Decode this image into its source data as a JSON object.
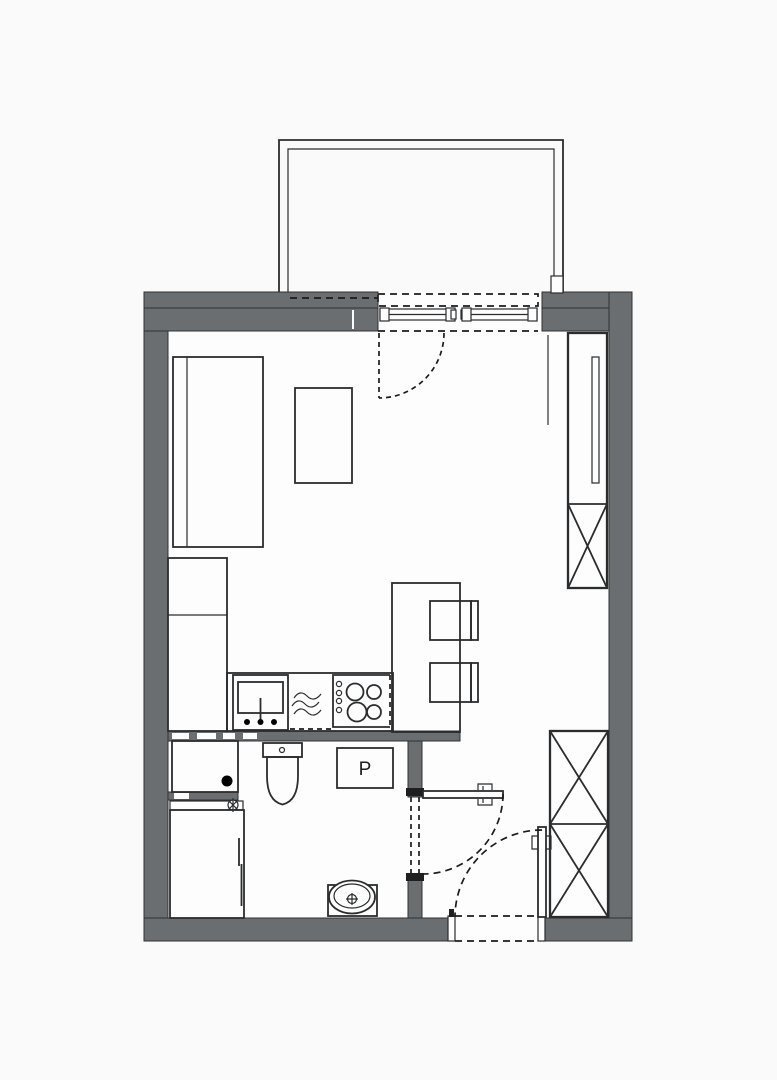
{
  "document": {
    "kind": "studio-apartment-floor-plan",
    "visible_text_labels": {
      "washing_machine": "P"
    }
  },
  "labels": {
    "washing_machine": "P"
  },
  "colors": {
    "wall_fill": "#6b6e70",
    "wall_edge": "#2f3133",
    "line": "#2a2c2e",
    "dash_line": "#1c1c1c",
    "background": "#fafafa",
    "floor": "#fdfdfd",
    "drain_fill": "#000000",
    "label_text": "#1f1f1f"
  },
  "fixtures": {
    "balcony": "balcony with parapet (double outline)",
    "balcony_window": "balcony window, two sliding panels",
    "balcony_door_swing": "dashed door swing arc into room",
    "bed": "single bed with headboard",
    "coffee_table": "coffee table",
    "storage_cabinet": "tall storage cabinet column",
    "kitchen_counter": "kitchen counter run",
    "kitchen_sink": "kitchen sink with faucet",
    "dishwasher": "dishwasher (wave symbol, dashed front)",
    "cooktop": "4-burner cooktop with knobs",
    "breakfast_bar": "kitchen peninsula / breakfast bar",
    "bar_chairs": "two bar chairs with backrests",
    "mirror_wardrobe": "tall wardrobe with mirror slit",
    "x_wardrobe_upper": "wardrobe (X symbol)",
    "x_wardrobe_lower": "double wardrobe (two X symbols)",
    "shower_tray": "shower tray with floor drain",
    "floor_drain": "floor drain (filled dot)",
    "shower_mixer": "mixer / drain valve symbol",
    "shower_cabinet": "shower cabinet with glass panel",
    "toilet": "toilet with cistern",
    "washing_machine": "washing machine (P = pralka)",
    "washbasin": "countertop washbasin with tap",
    "bathroom_door": "bathroom swing door with arc",
    "entrance_door": "entrance swing door with arc"
  }
}
